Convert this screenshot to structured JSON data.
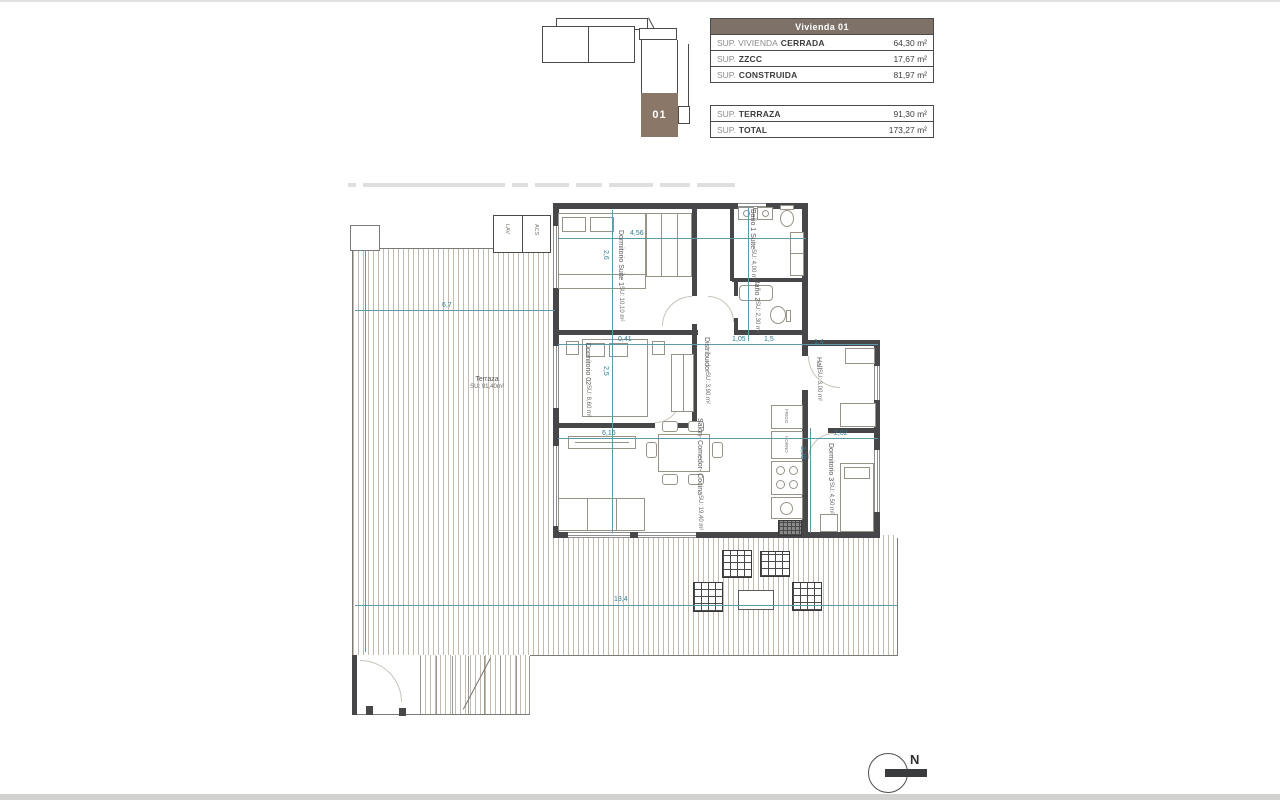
{
  "sheet": {
    "title": "Vivienda 01"
  },
  "key_plan": {
    "unit_label": "01",
    "accent_brown": "#8b7767"
  },
  "area_table": {
    "header": "Vivienda 01",
    "header_bg": "#7d7168",
    "groups": [
      {
        "rows": [
          {
            "prefix": "SUP. VIVIENDA",
            "bold": "CERRADA",
            "value": "64,30 m²"
          },
          {
            "prefix": "SUP.",
            "bold": "ZZCC",
            "value": "17,67 m²"
          },
          {
            "prefix": "SUP.",
            "bold": "CONSTRUIDA",
            "value": "81,97 m²"
          }
        ]
      },
      {
        "rows": [
          {
            "prefix": "SUP.",
            "bold": "TERRAZA",
            "value": "91,30 m²"
          },
          {
            "prefix": "SUP.",
            "bold": "TOTAL",
            "value": "173,27 m²"
          }
        ]
      }
    ]
  },
  "plan": {
    "rooms": [
      {
        "name": "Dormitorio Suite 1",
        "area": "SU: 10,10 m²"
      },
      {
        "name": "Baño 1 Suite",
        "area": "SU: 4,00 m²"
      },
      {
        "name": "Baño 2",
        "area": "SU: 2,30 m²"
      },
      {
        "name": "Dormitorio 02",
        "area": "SU: 8,60 m²"
      },
      {
        "name": "Distribuidor",
        "area": "SU: 3,90 m²"
      },
      {
        "name": "Hall",
        "area": "SU: 3,00 m²"
      },
      {
        "name": "Dormitorio 3",
        "area": "SU: 4,50 m²"
      },
      {
        "name": "Salón- Comedor- Cocina",
        "area": "SU: 19,40 m²"
      },
      {
        "name": "Terraza",
        "area": "SU: 91,40m²"
      }
    ],
    "dims": [
      "4,56",
      "2,6",
      "6,7",
      "0,41",
      "1,05",
      "1,5",
      "1,4",
      "2,5",
      "2,02",
      "6,16",
      "3,35",
      "13,4"
    ],
    "closets": {
      "lav": "LAV",
      "acs": "ACS"
    },
    "kitchen": {
      "fridge": "FRIGO",
      "oven": "HORNO"
    },
    "compass": {
      "north_label": "N"
    },
    "colors": {
      "wall": "#47474a",
      "dimension_blue": "#2f7d92",
      "hatch": "#c3bbb0"
    }
  }
}
